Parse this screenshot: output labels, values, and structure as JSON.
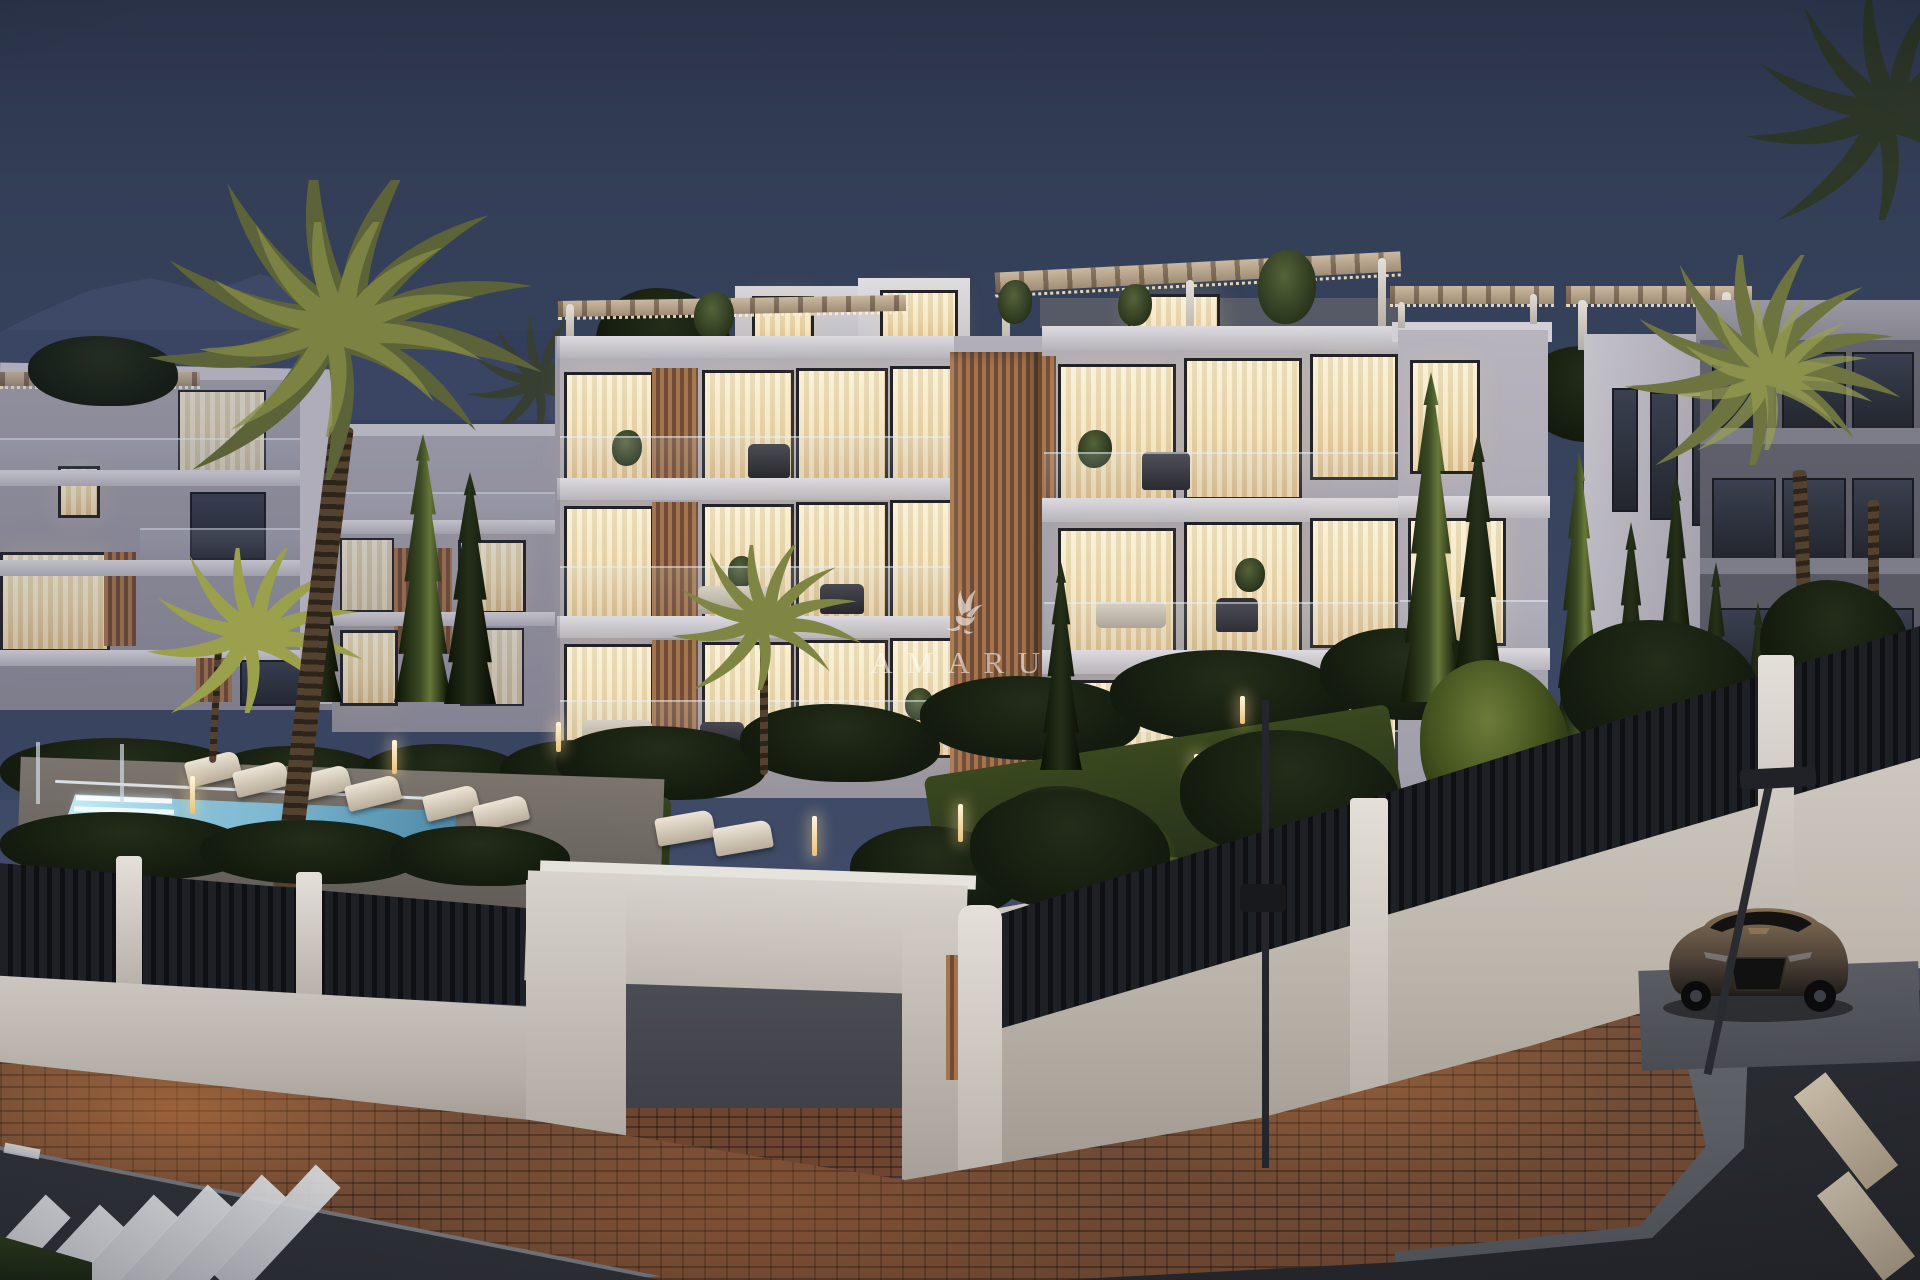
{
  "watermark": {
    "brand": "AMARU",
    "logo_icon": "hummingbird-flourish-logo-icon"
  },
  "palette": {
    "sky_top": "#313b53",
    "sky_mid": "#38445f",
    "sky_bottom": "#4a5570",
    "mountain": "#3e4a67",
    "facade_light": "#d6d4da",
    "facade_mid": "#a9a7b1",
    "facade_shadow": "#83828c",
    "window_warm": "#f7ecca",
    "window_warm_deep": "#e2c492",
    "window_frame": "#232327",
    "wood_slat": "#a4744e",
    "wood_slat_dark": "#6f4b36",
    "pergola_wood": "#cbb89f",
    "foliage_dark": "#131a0e",
    "foliage_lit": "#6d7c3a",
    "palm_olive": "#5c6338",
    "palm_lit": "#9aa04c",
    "pool_water": "#7fb8d2",
    "pool_glow": "#c2e9f5",
    "fence_black": "#0e1013",
    "wall_white": "#cfc9c3",
    "road_asphalt": "#2b2e34",
    "road_stripe": "#d8dade",
    "brick_paving": "#6b4632",
    "brick_lit": "#b47a4e",
    "curb_gray": "#70737a",
    "car_bronze": "#846f54",
    "watermark_white": "#ffffff"
  }
}
